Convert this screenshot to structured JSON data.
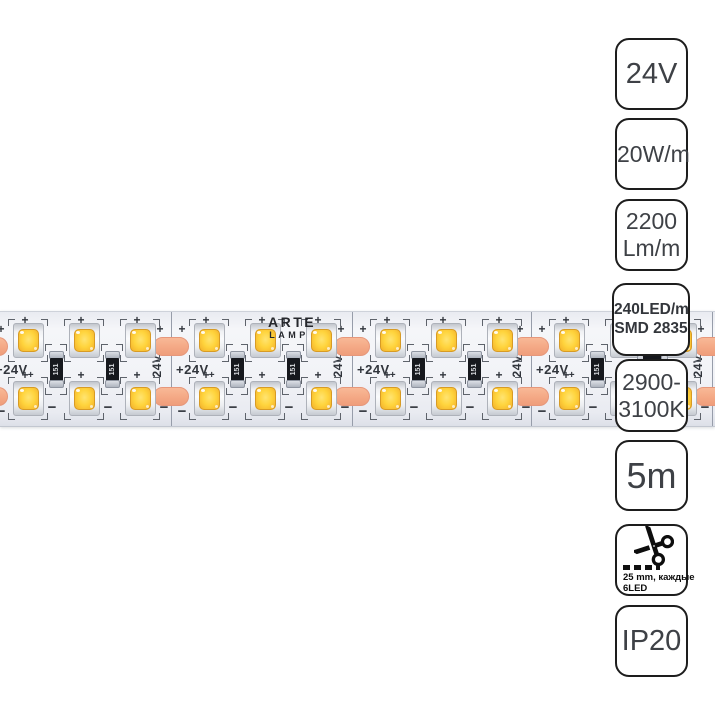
{
  "badges": [
    {
      "id": "voltage",
      "lines": [
        "24V"
      ]
    },
    {
      "id": "power",
      "lines": [
        "20W/m"
      ]
    },
    {
      "id": "luminous-flux",
      "lines": [
        "2200",
        "Lm/m"
      ]
    },
    {
      "id": "led-density",
      "lines": [
        "240LED/m",
        "SMD 2835"
      ]
    },
    {
      "id": "color-temperature",
      "lines": [
        "2900-",
        "3100K"
      ]
    },
    {
      "id": "length",
      "lines": [
        "5m"
      ]
    },
    {
      "id": "cut-step",
      "icon": "scissors-icon",
      "lines": [
        "25 mm, каждые",
        "6LED"
      ]
    },
    {
      "id": "ip-rating",
      "lines": [
        "IP20"
      ]
    }
  ],
  "strip": {
    "brand": {
      "line1": "ARTE",
      "line2": "LAMP"
    },
    "markings": {
      "voltage_horizontal": "+24V",
      "voltage_horizontal_sub": "+",
      "voltage_vertical": "24V",
      "resistor_code": "151",
      "plus": "+",
      "minus": "−"
    },
    "layout": {
      "visible_segments": 4,
      "rows": 2,
      "leds_per_row_per_segment": 3,
      "resistors_per_segment": 2,
      "cut_points": 5
    }
  },
  "colors": {
    "pcb": "#f1f2f6",
    "led_window": "#ffd43d",
    "copper_pad": "#f4a886",
    "print": "#31353c",
    "badge_border": "#1d1d1d",
    "badge_text": "#3e4146"
  }
}
